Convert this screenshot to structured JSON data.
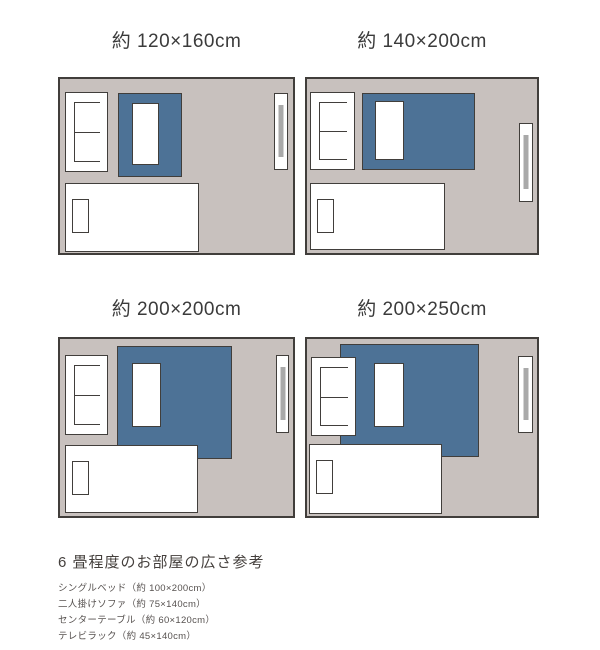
{
  "colors": {
    "room_bg": "#c8c1be",
    "rug": "#4d7296",
    "outline": "#413e3b",
    "tv_strip": "#a9a9a9",
    "furniture_fill": "#ffffff"
  },
  "diagrams": [
    {
      "title": "約 120×160cm"
    },
    {
      "title": "約 140×200cm"
    },
    {
      "title": "約 200×200cm"
    },
    {
      "title": "約 200×250cm"
    }
  ],
  "legend": {
    "heading": "6 畳程度のお部屋の広さ参考",
    "items": [
      {
        "label": "シングルベッド（約 100×200cm）"
      },
      {
        "label": "二人掛けソファ（約 75×140cm）"
      },
      {
        "label": "センターテーブル（約 60×120cm）"
      },
      {
        "label": "テレビラック（約 45×140cm）"
      }
    ]
  }
}
